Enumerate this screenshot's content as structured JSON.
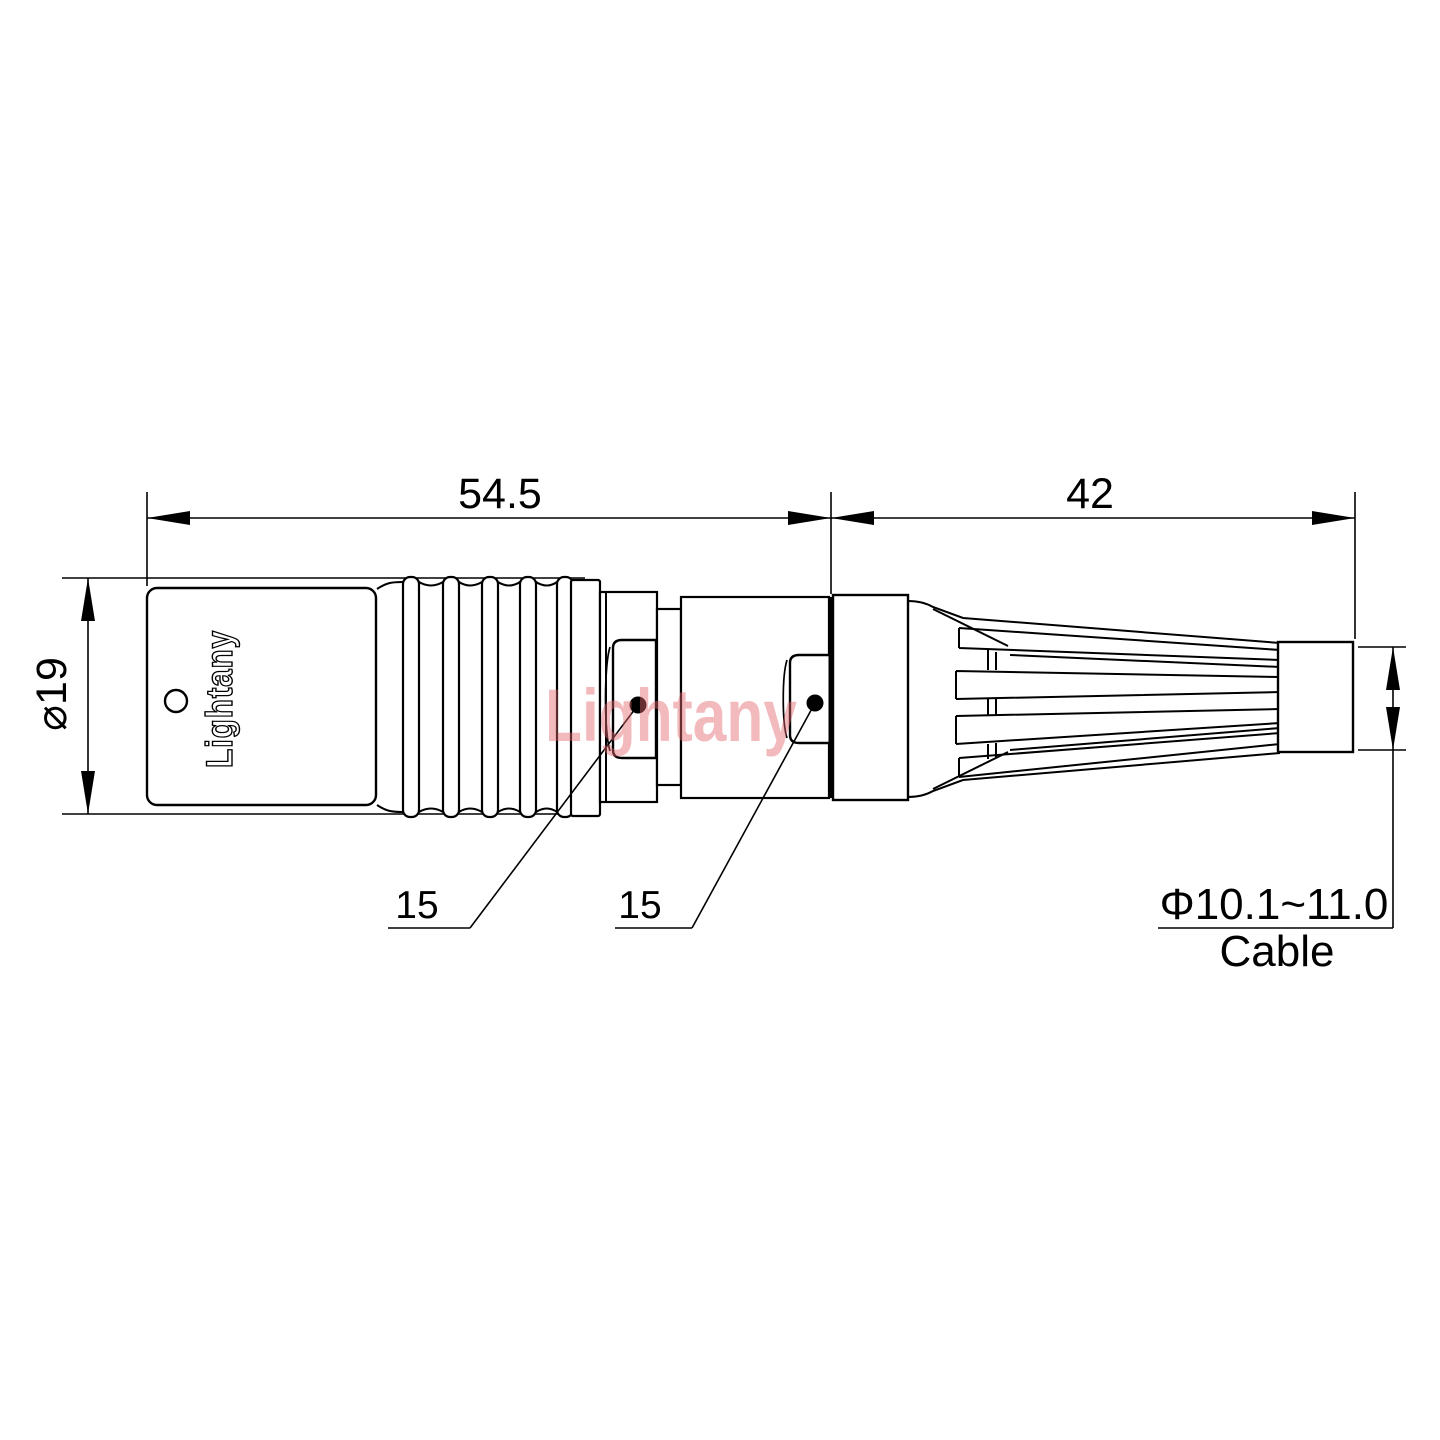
{
  "drawing": {
    "type": "connector-technical-drawing",
    "brand": "Lightany",
    "watermark": "Lightany",
    "dimensions": {
      "connector_length": "54.5",
      "boot_length": "42",
      "shell_diameter": "⌀19",
      "wrench_flat_a": "15",
      "wrench_flat_b": "15",
      "cable_diameter_range": "Φ10.1~11.0",
      "cable_label": "Cable"
    },
    "colors": {
      "line": "#000000",
      "background": "#ffffff",
      "watermark_pink": "#f3babd"
    }
  }
}
